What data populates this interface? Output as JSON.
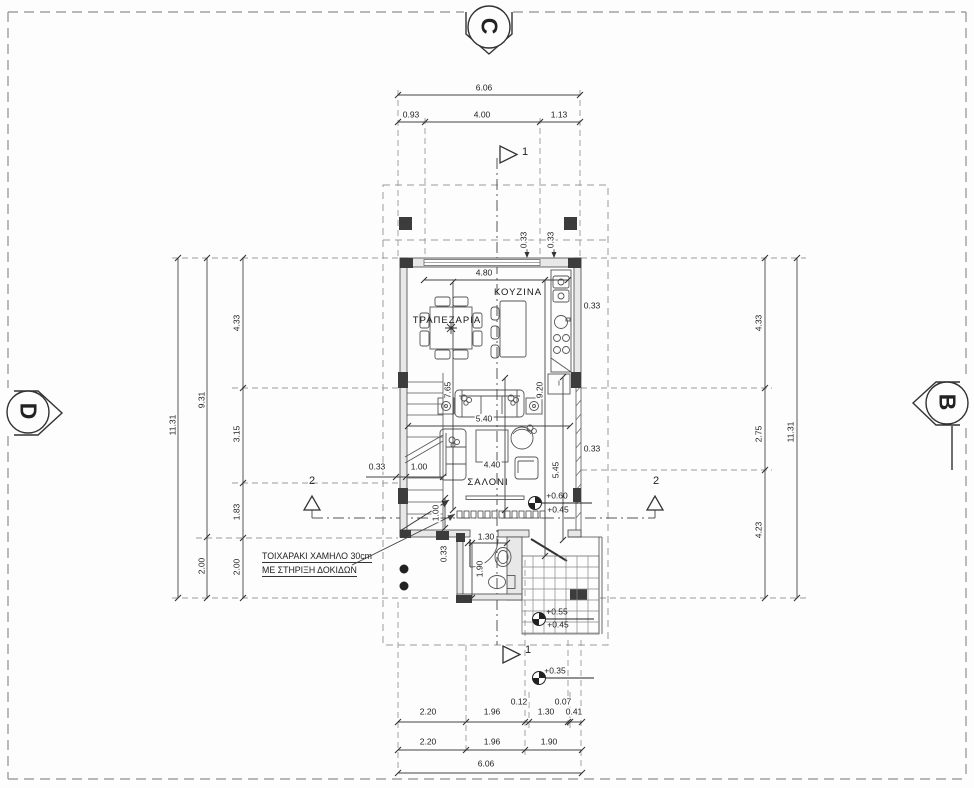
{
  "drawing": {
    "markers": {
      "top": "C",
      "left": "D",
      "right": "B",
      "cut_1": "1",
      "cut_2": "2"
    },
    "rooms": {
      "dining": "ΤΡΑΠΕΖΑΡΙΑ",
      "kitchen": "ΚΟΥΖΙΝΑ",
      "living": "ΣΑΛΟΝΙ"
    },
    "note": {
      "line1": "ΤΟΙΧΑΡΑΚΙ ΧΑΜΗΛΟ 30cm",
      "line2": "ΜΕ ΣΤΗΡΙΞΗ ΔΟΚΙΔΩΝ"
    },
    "appliance": {
      "fridge": "I"
    },
    "levels": {
      "living_a": "+0.60",
      "living_b": "+0.45",
      "porch_a": "+0.55",
      "porch_b": "+0.45",
      "step": "+0.35"
    },
    "dims": {
      "top_total": "6.06",
      "top_row": [
        "0.93",
        "4.00",
        "1.13"
      ],
      "window_top": "4.80",
      "wall_33_a": "0.33",
      "wall_33_b": "0.33",
      "wall_33_right_top": "0.33",
      "wall_33_right_low": "0.33",
      "wall_33_left": "0.33",
      "wall_33_wc": "0.33",
      "stair_depth": "7.65",
      "kitchen_depth": "9.20",
      "living_width": "5.40",
      "living_depth": "4.40",
      "right_depth": "5.45",
      "stair_width": "1.00",
      "stair_run": "1.00",
      "wc_width": "1.30",
      "wc_depth": "1.90",
      "left_outer": "11.31",
      "left_mid": [
        "9.31",
        "2.00"
      ],
      "left_inner": [
        "4.33",
        "3.15",
        "1.83",
        "2.00"
      ],
      "right_inner": [
        "4.33",
        "2.75",
        "4.23"
      ],
      "right_outer": "11.31",
      "bottom_small": [
        "0.12",
        "0.07"
      ],
      "bottom_row1": [
        "2.20",
        "1.96",
        "1.30",
        "0.41"
      ],
      "bottom_row2": [
        "2.20",
        "1.96",
        "1.90"
      ],
      "bottom_total": "6.06"
    }
  }
}
